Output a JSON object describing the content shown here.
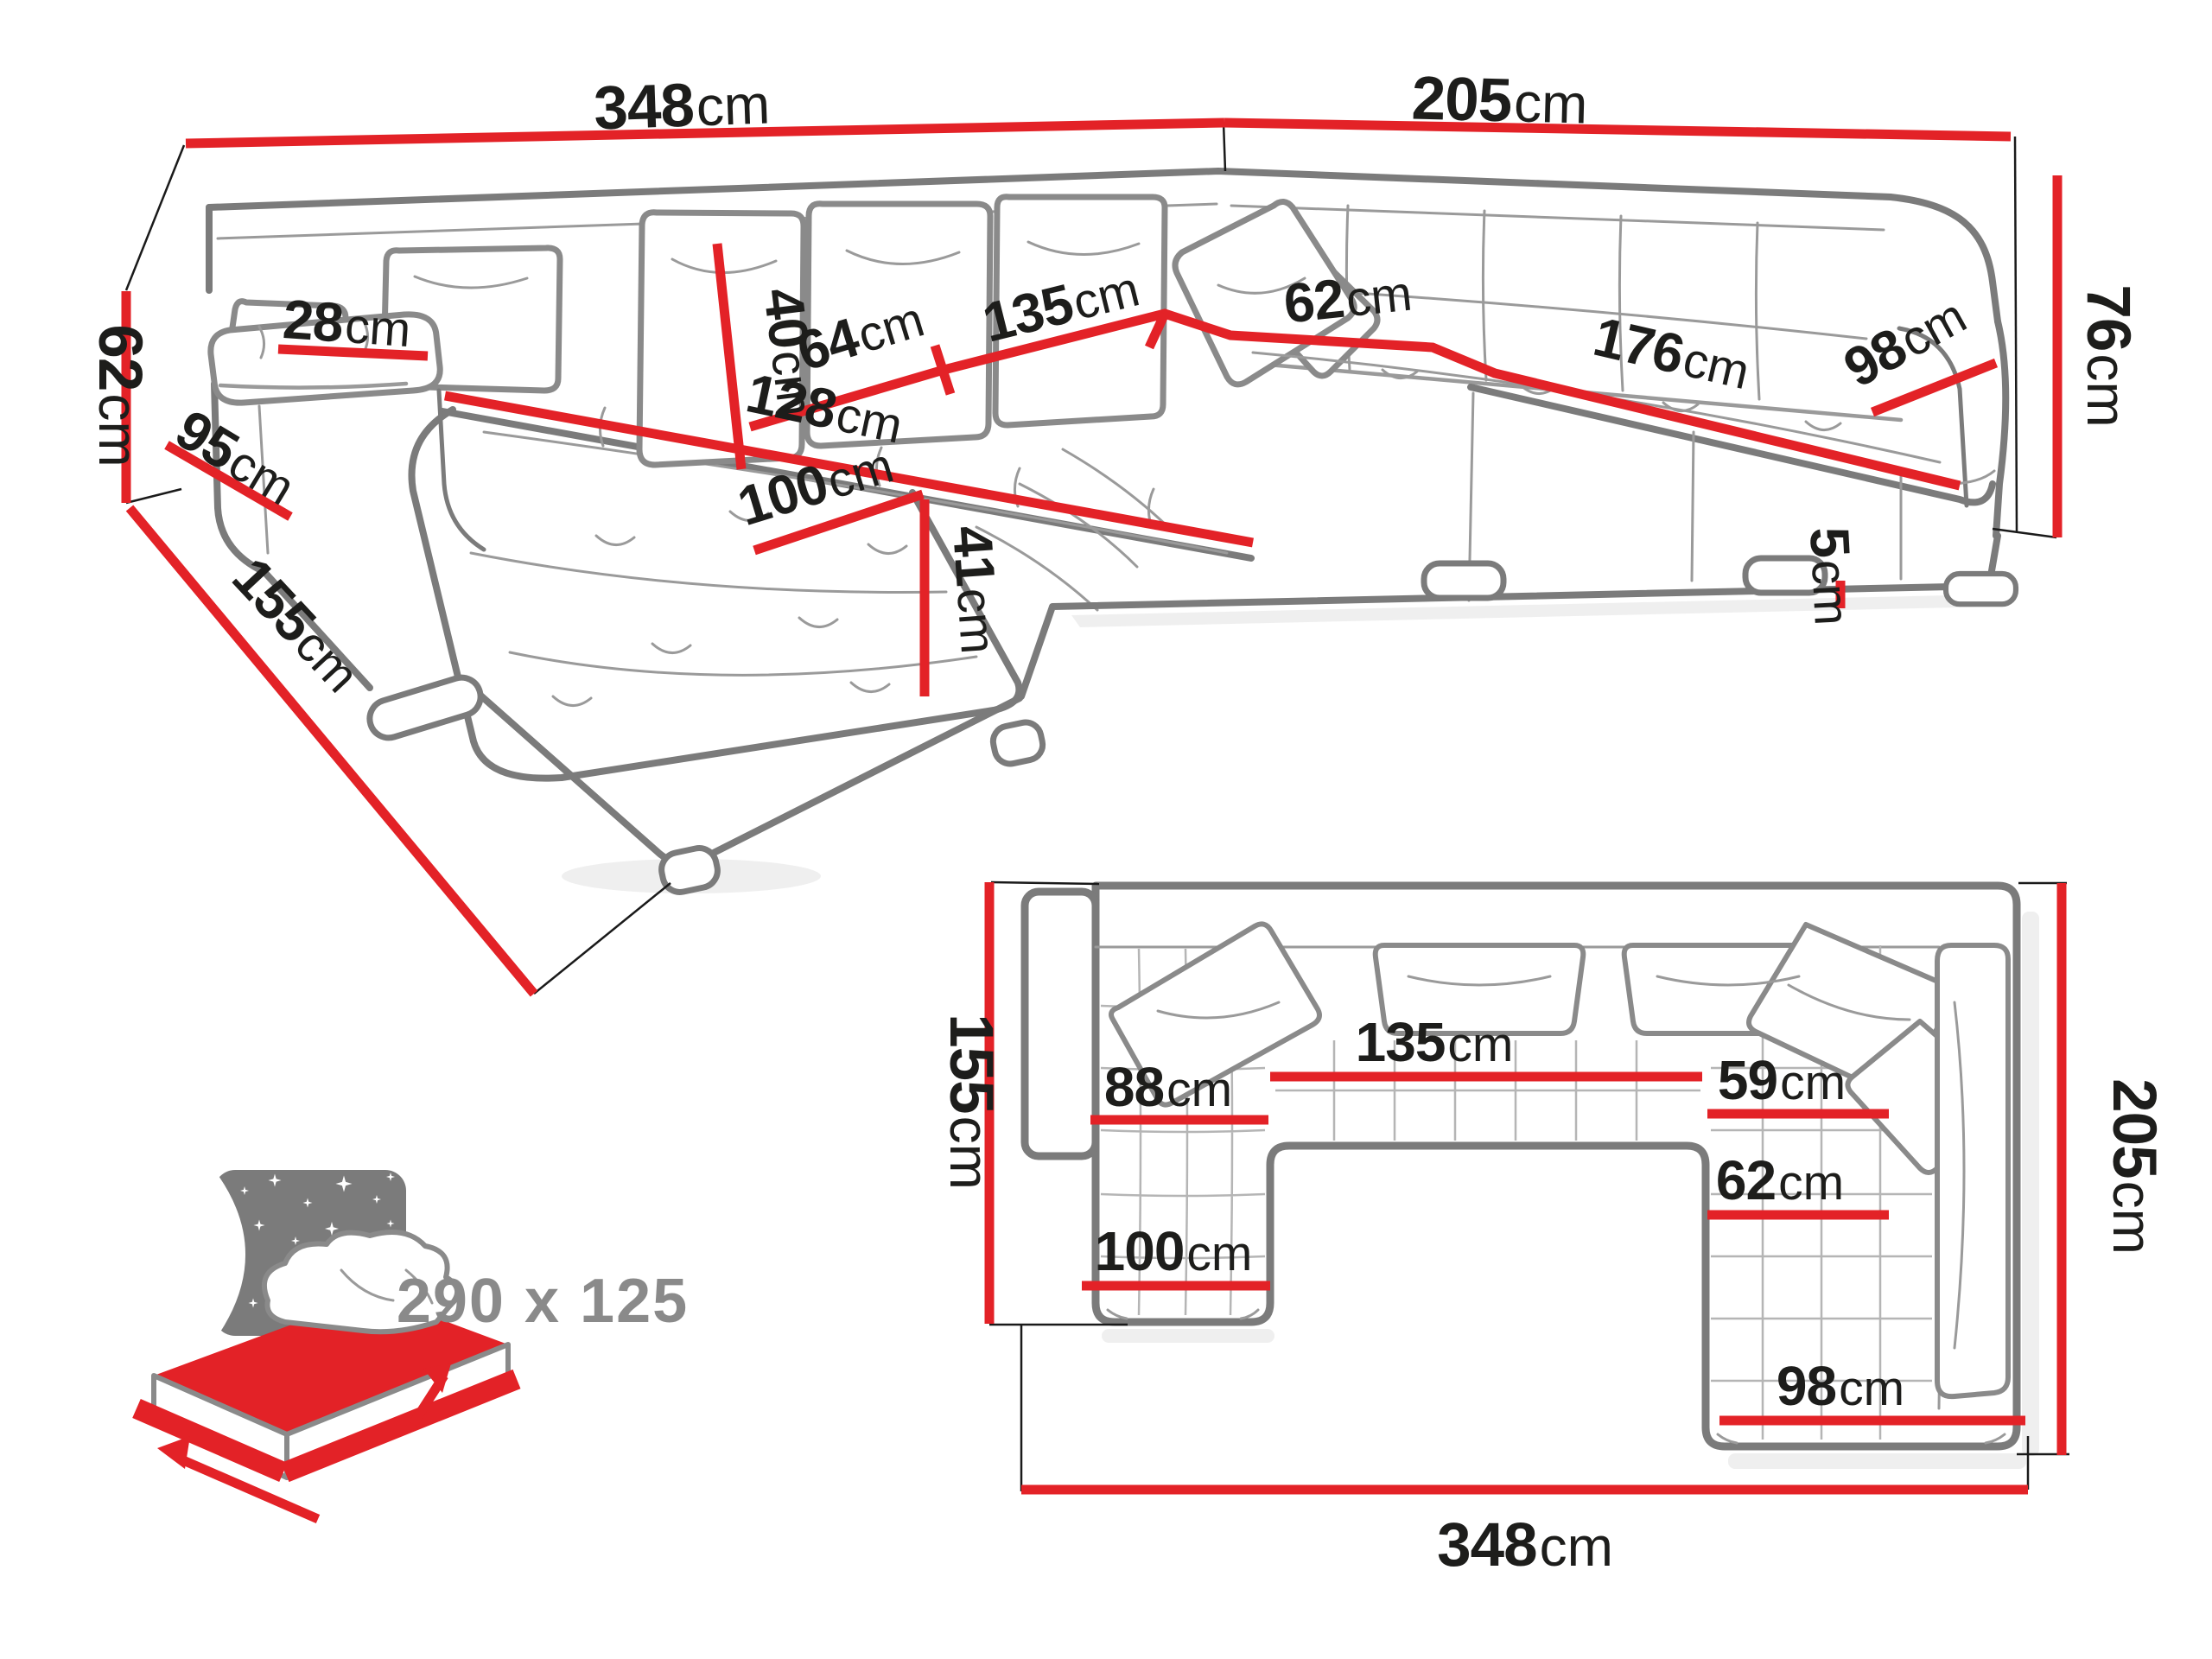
{
  "palette": {
    "red": "#e32227",
    "outline": "#7b7b7b",
    "thin": "#9a9a9a",
    "text": "#1d1d1b",
    "muted": "#8a8a8a"
  },
  "perspective": {
    "d348": {
      "num": "348",
      "unit": "cm"
    },
    "d205": {
      "num": "205",
      "unit": "cm"
    },
    "d76": {
      "num": "76",
      "unit": "cm"
    },
    "d62_left": {
      "num": "62",
      "unit": "cm"
    },
    "d95": {
      "num": "95",
      "unit": "cm"
    },
    "d28": {
      "num": "28",
      "unit": "cm"
    },
    "d40": {
      "num": "40",
      "unit": "cm"
    },
    "d64": {
      "num": "64",
      "unit": "cm"
    },
    "d135": {
      "num": "135",
      "unit": "cm"
    },
    "d62_mid": {
      "num": "62",
      "unit": "cm"
    },
    "d176": {
      "num": "176",
      "unit": "cm"
    },
    "d98": {
      "num": "98",
      "unit": "cm"
    },
    "d128": {
      "num": "128",
      "unit": "cm"
    },
    "d100": {
      "num": "100",
      "unit": "cm"
    },
    "d41": {
      "num": "41",
      "unit": "cm"
    },
    "d5": {
      "num": "5",
      "unit": "cm"
    },
    "d155": {
      "num": "155",
      "unit": "cm"
    }
  },
  "plan": {
    "d155": {
      "num": "155",
      "unit": "cm"
    },
    "d205": {
      "num": "205",
      "unit": "cm"
    },
    "d348": {
      "num": "348",
      "unit": "cm"
    },
    "d88": {
      "num": "88",
      "unit": "cm"
    },
    "d135": {
      "num": "135",
      "unit": "cm"
    },
    "d59": {
      "num": "59",
      "unit": "cm"
    },
    "d62": {
      "num": "62",
      "unit": "cm"
    },
    "d100": {
      "num": "100",
      "unit": "cm"
    },
    "d98": {
      "num": "98",
      "unit": "cm"
    }
  },
  "sleeping": {
    "size": "290 x 125"
  }
}
